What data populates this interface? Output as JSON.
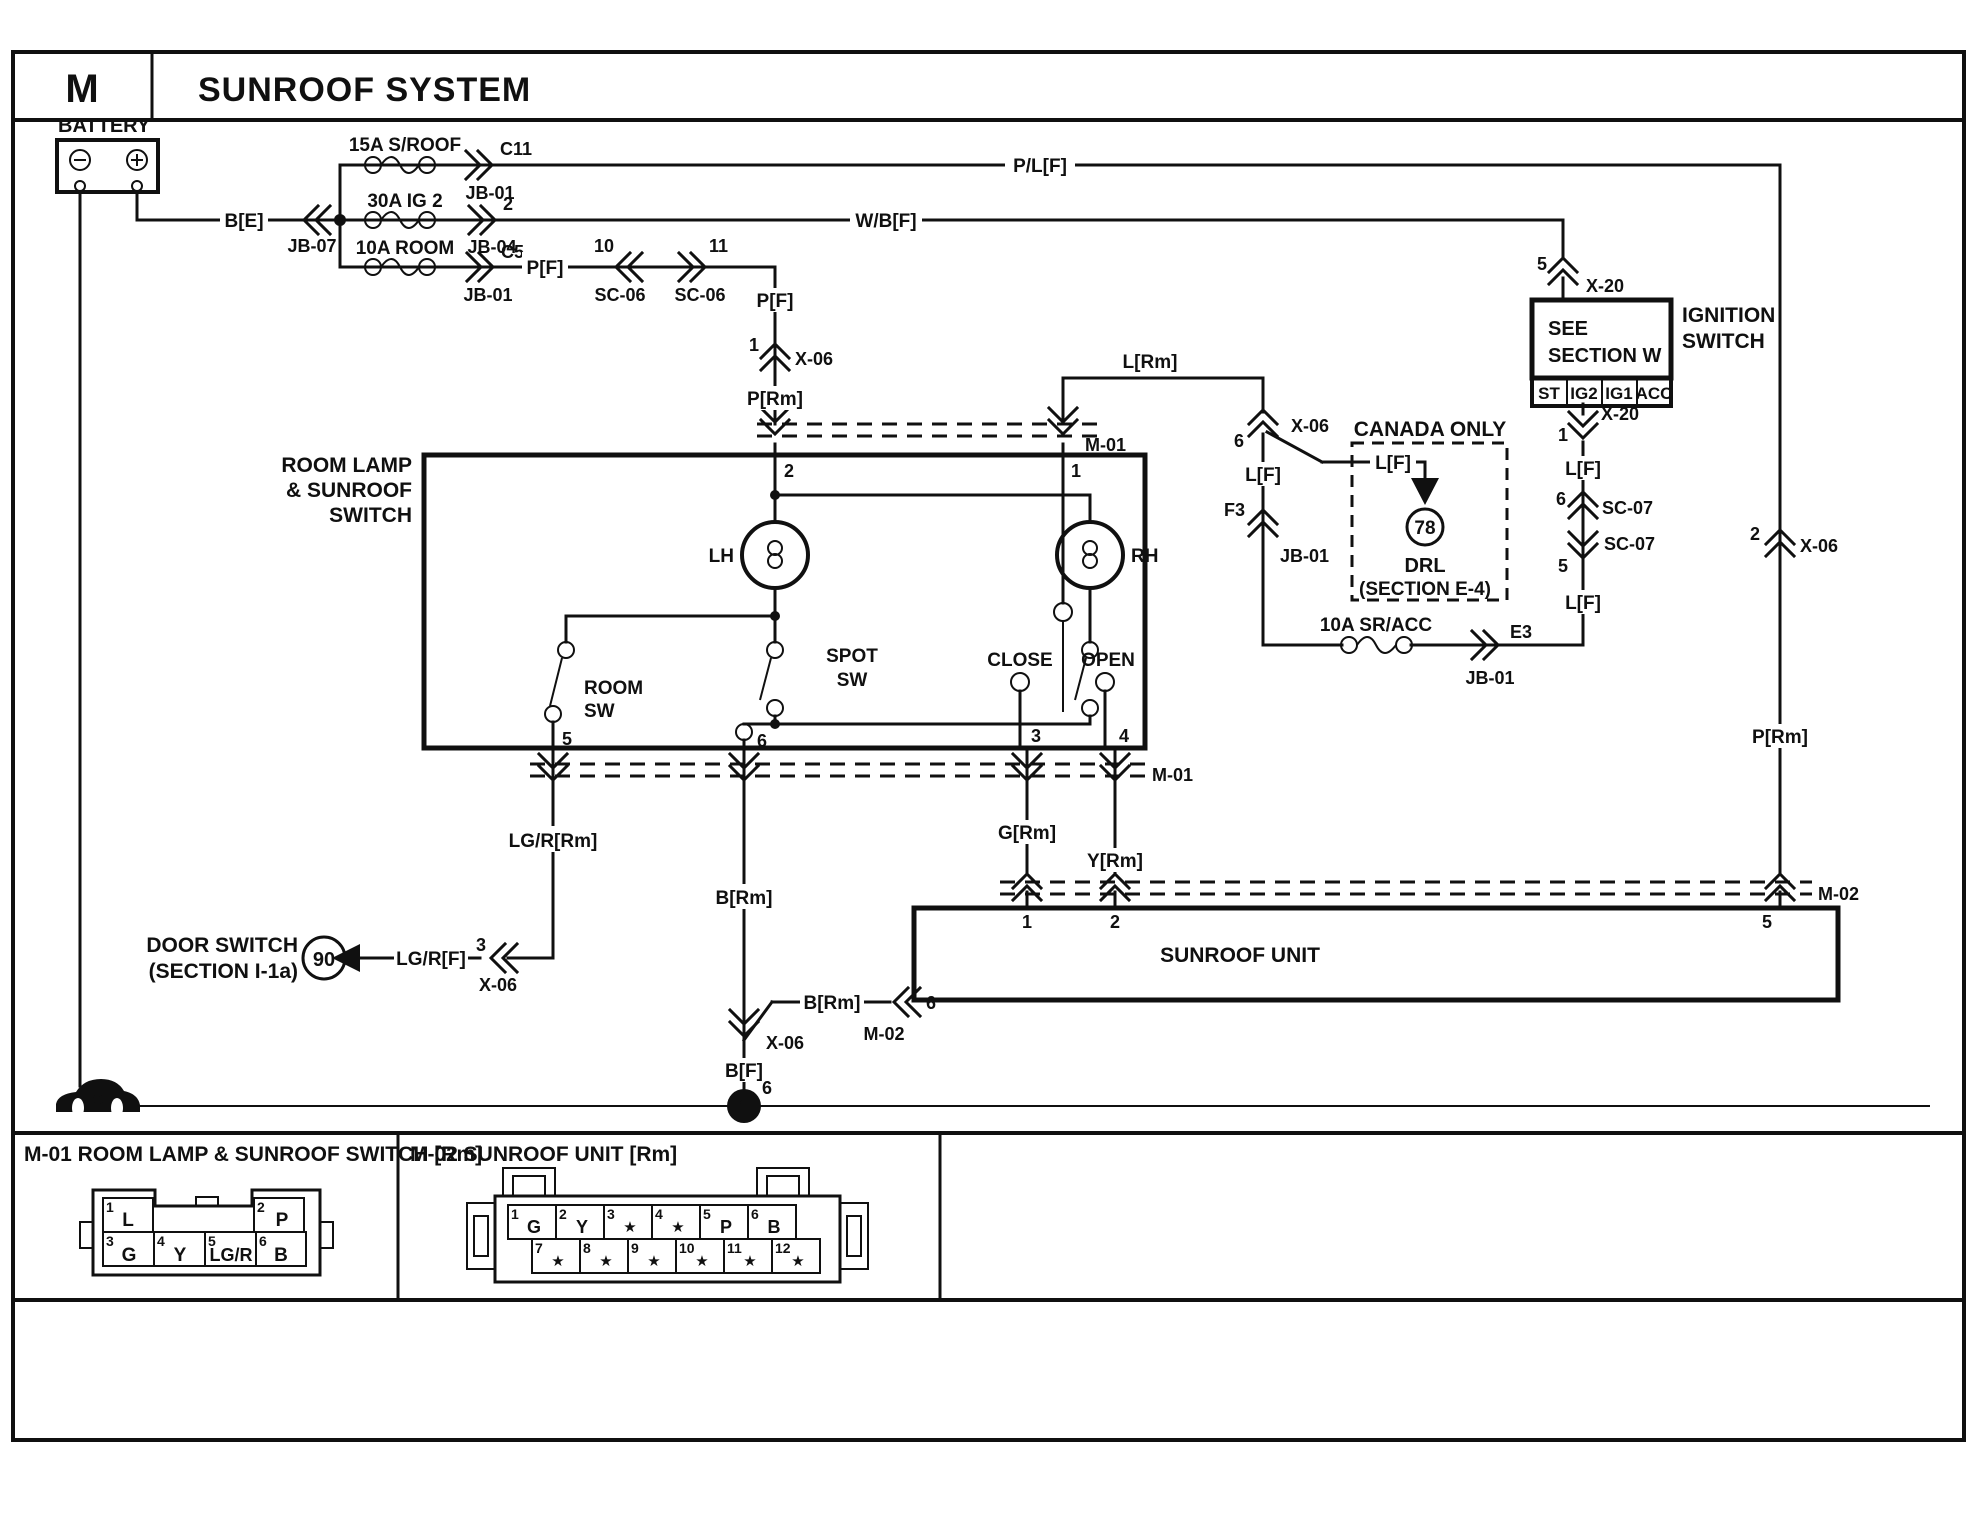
{
  "header": {
    "code": "M",
    "title": "SUNROOF SYSTEM"
  },
  "battery": {
    "label": "BATTERY"
  },
  "fuses": {
    "sroof": "15A S/ROOF",
    "ig2": "30A IG 2",
    "room": "10A ROOM",
    "sracc": "10A SR/ACC"
  },
  "wires": {
    "be": "B[E]",
    "plf": "P/L[F]",
    "wbf": "W/B[F]",
    "pf": "P[F]",
    "prm": "P[Rm]",
    "lrm": "L[Rm]",
    "lf": "L[F]",
    "lgr_rm": "LG/R[Rm]",
    "lgr_f": "LG/R[F]",
    "brm": "B[Rm]",
    "bf": "B[F]",
    "grm": "G[Rm]",
    "yrm": "Y[Rm]"
  },
  "connectors": {
    "jb07": "JB-07",
    "jb01": "JB-01",
    "jb04": "JB-04",
    "c11": "C11",
    "c5": "C5",
    "sc06": "SC-06",
    "sc07": "SC-07",
    "x06": "X-06",
    "x20": "X-20",
    "m01": "M-01",
    "m02": "M-02",
    "e3": "E3",
    "f3": "F3"
  },
  "pins": {
    "n1": "1",
    "n2": "2",
    "n3": "3",
    "n4": "4",
    "n5": "5",
    "n6": "6",
    "n10": "10",
    "n11": "11"
  },
  "ignition": {
    "box_line1": "SEE",
    "box_line2": "SECTION W",
    "terminals": [
      "ST",
      "IG2",
      "IG1",
      "ACC"
    ],
    "name_line1": "IGNITION",
    "name_line2": "SWITCH"
  },
  "canada": {
    "title": "CANADA ONLY",
    "wire": "L[F]",
    "circuit": "78",
    "name": "DRL",
    "section": "(SECTION E-4)"
  },
  "switch_box": {
    "name_line1": "ROOM LAMP",
    "name_line2": "& SUNROOF",
    "name_line3": "SWITCH",
    "lh": "LH",
    "rh": "RH",
    "spot_line1": "SPOT",
    "spot_line2": "SW",
    "room_line1": "ROOM",
    "room_line2": "SW",
    "close": "CLOSE",
    "open": "OPEN"
  },
  "door_switch": {
    "name_line1": "DOOR SWITCH",
    "name_line2": "(SECTION I-1a)",
    "circuit": "90"
  },
  "sunroof_unit": {
    "label": "SUNROOF UNIT"
  },
  "ground": {
    "num": "1",
    "pin": "6",
    "car_letter": "G"
  },
  "m01_detail": {
    "title": "M-01 ROOM LAMP & SUNROOF SWITCH [Rm]",
    "top_pins": [
      {
        "n": "1",
        "label": "L"
      },
      {
        "n": "2",
        "label": "P"
      }
    ],
    "bottom_pins": [
      {
        "n": "3",
        "label": "G"
      },
      {
        "n": "4",
        "label": "Y"
      },
      {
        "n": "5",
        "label": "LG/R"
      },
      {
        "n": "6",
        "label": "B"
      }
    ]
  },
  "m02_detail": {
    "title": "M-02 SUNROOF UNIT [Rm]",
    "row1": [
      {
        "n": "1",
        "label": "G"
      },
      {
        "n": "2",
        "label": "Y"
      },
      {
        "n": "3",
        "label": "★"
      },
      {
        "n": "4",
        "label": "★"
      },
      {
        "n": "5",
        "label": "P"
      },
      {
        "n": "6",
        "label": "B"
      }
    ],
    "row2": [
      {
        "n": "7",
        "label": "★"
      },
      {
        "n": "8",
        "label": "★"
      },
      {
        "n": "9",
        "label": "★"
      },
      {
        "n": "10",
        "label": "★"
      },
      {
        "n": "11",
        "label": "★"
      },
      {
        "n": "12",
        "label": "★"
      }
    ]
  }
}
